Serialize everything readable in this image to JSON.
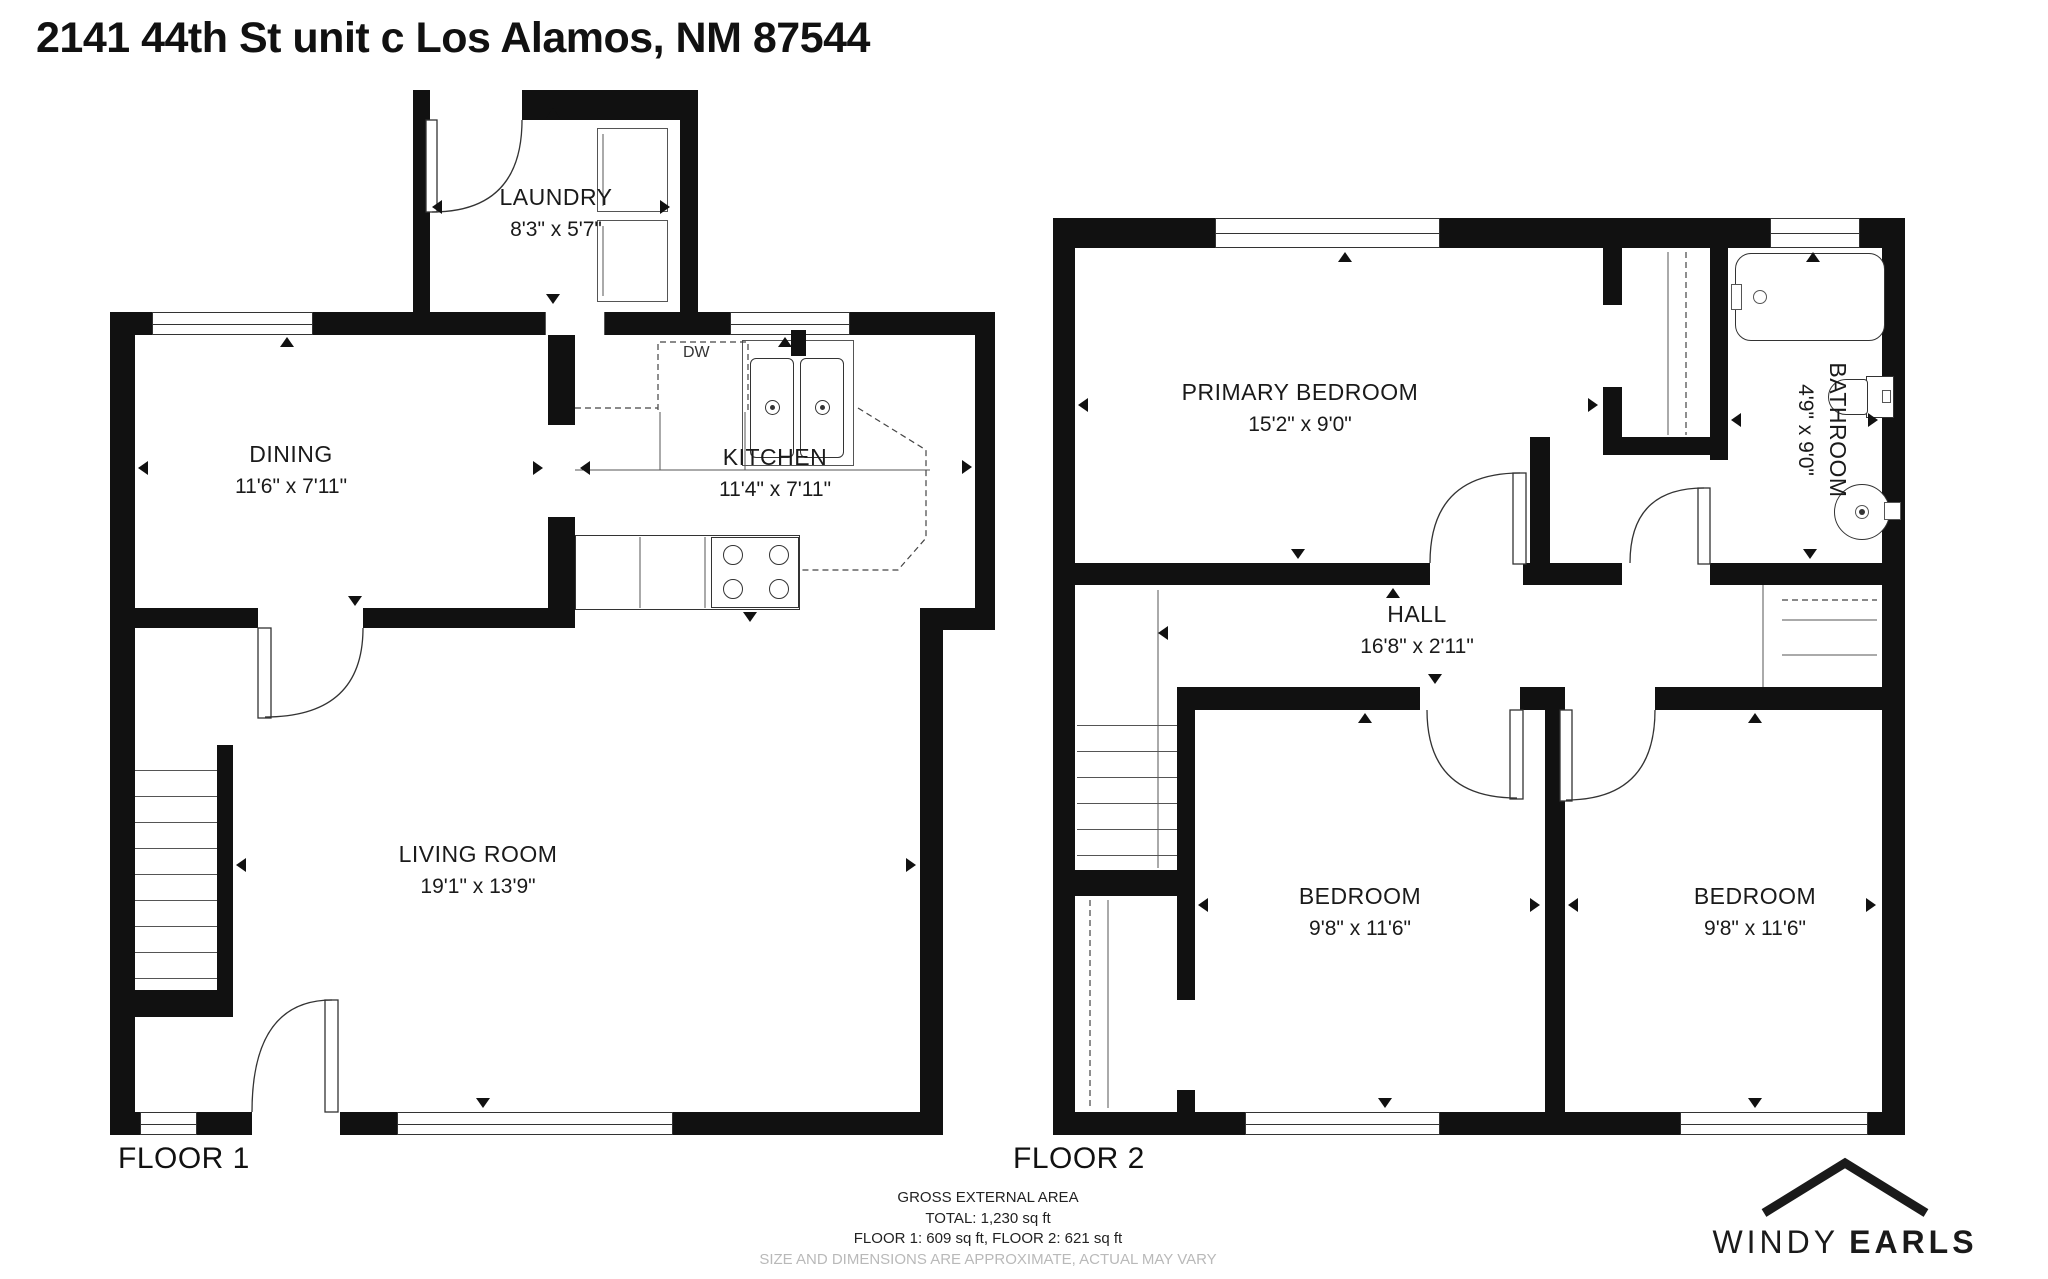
{
  "title": "2141 44th St unit c Los Alamos, NM 87544",
  "floor1": {
    "label": "FLOOR 1",
    "rooms": {
      "laundry": {
        "name": "LAUNDRY",
        "dims": "8'3\" x 5'7\""
      },
      "dining": {
        "name": "DINING",
        "dims": "11'6\" x 7'11\""
      },
      "kitchen": {
        "name": "KITCHEN",
        "dims": "11'4\" x 7'11\""
      },
      "living": {
        "name": "LIVING ROOM",
        "dims": "19'1\" x 13'9\""
      }
    },
    "appliances": {
      "dishwasher": "DW"
    }
  },
  "floor2": {
    "label": "FLOOR 2",
    "rooms": {
      "primary": {
        "name": "PRIMARY BEDROOM",
        "dims": "15'2\" x 9'0\""
      },
      "bathroom": {
        "name": "BATHROOM",
        "dims": "4'9\" x 9'0\""
      },
      "hall": {
        "name": "HALL",
        "dims": "16'8\" x 2'11\""
      },
      "bedroom_left": {
        "name": "BEDROOM",
        "dims": "9'8\" x 11'6\""
      },
      "bedroom_right": {
        "name": "BEDROOM",
        "dims": "9'8\" x 11'6\""
      }
    }
  },
  "footer": {
    "lines": [
      "GROSS EXTERNAL AREA",
      "TOTAL: 1,230 sq ft",
      "FLOOR 1: 609 sq ft, FLOOR 2: 621 sq ft",
      "SIZE AND DIMENSIONS ARE APPROXIMATE, ACTUAL MAY VARY"
    ]
  },
  "logo": {
    "first": "WINDY",
    "second": "EARLS"
  }
}
